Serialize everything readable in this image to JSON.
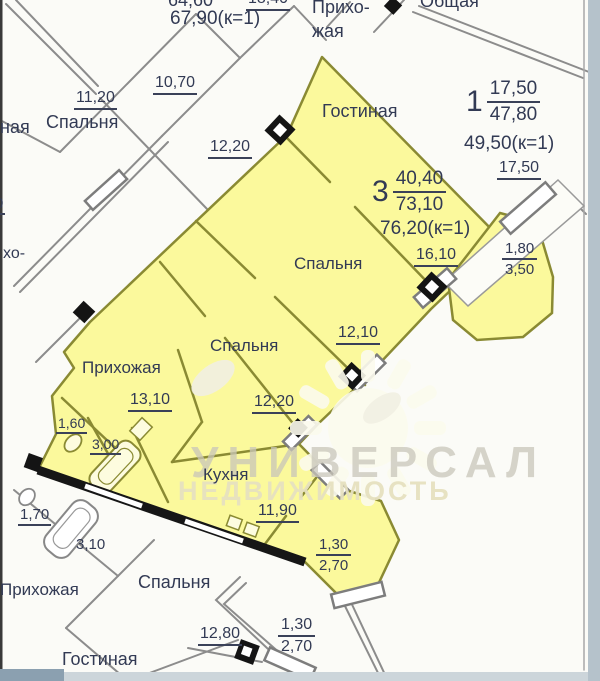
{
  "watermark": {
    "brand": "УНИВЕРСАЛ",
    "subtitle": "НЕДВИЖИМОСТЬ"
  },
  "apt3": {
    "num": "3",
    "living": "40,40",
    "total": "73,10",
    "coef": "76,20(к=1)"
  },
  "apt1": {
    "num": "1",
    "living": "17,50",
    "total": "47,80",
    "coef": "49,50(к=1)"
  },
  "labels": {
    "gostinaya": "Гостиная",
    "spalnya": "Спальня",
    "prihozhaya": "Прихожая",
    "kuhnya": "Кухня",
    "obshchaya": "Общая",
    "priho": "Прихо-",
    "zhaya": "жая",
    "naya": "ная",
    "ho": "хо-"
  },
  "dims": {
    "top_area": "64,60",
    "top_area2": "18,40",
    "top_coef": "67,90(к=1)",
    "tl_bedroom": "11,20",
    "tl_hall": "10,70",
    "corridor": "12,20",
    "apt1_room": "17,50",
    "bedroom1": "16,10",
    "bedroom2": "12,10",
    "bedroom3": "12,20",
    "hall": "13,10",
    "wc": "1,60",
    "bath": "3,00",
    "kitchen": "11,90",
    "balc_r_w": "1,80",
    "balc_r_a": "3,50",
    "balc_b_w": "1,30",
    "balc_b_a": "2,70",
    "nb_wc": "1,70",
    "nb_bath": "3,10",
    "nb_bedroom": "12,80",
    "nb_balc_w": "1,30",
    "nb_balc_a": "2,70",
    "partial_left": "0"
  }
}
